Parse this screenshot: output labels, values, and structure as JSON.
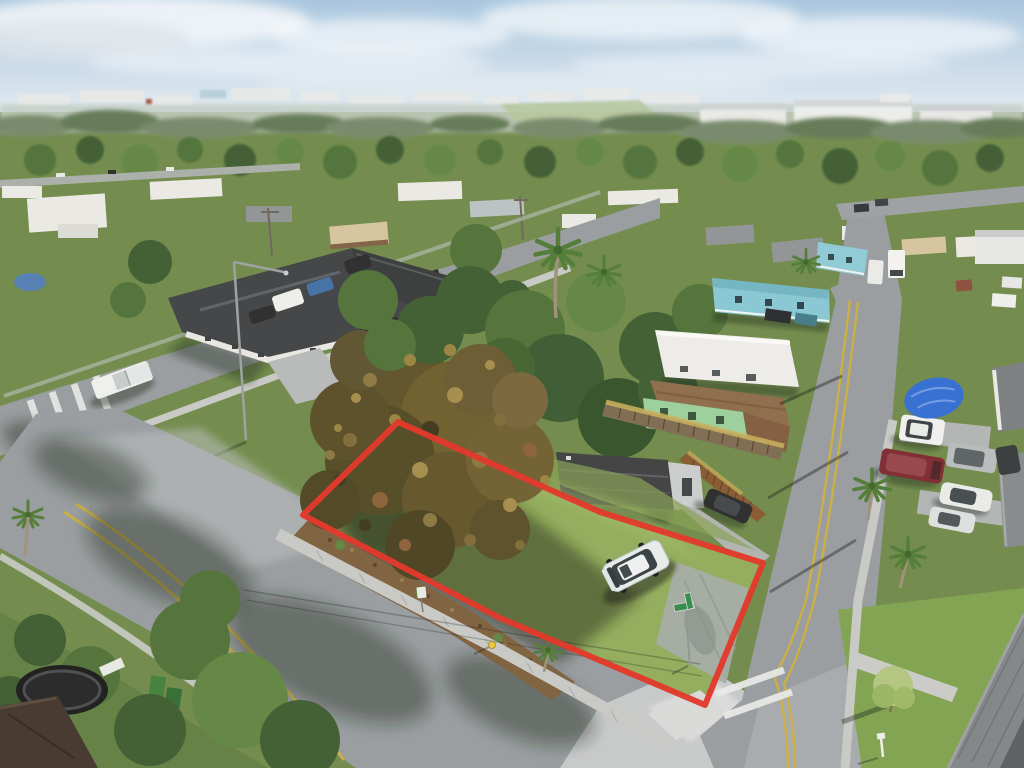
{
  "scene": {
    "type": "aerial-drone-photo",
    "subject": "Vacant corner lot outlined in red at a residential intersection",
    "setting": "Low-rise suburban neighborhood, hazy horizon, low warm sunlight with long shadows",
    "view": "High oblique aerial view",
    "width_px": 1024,
    "height_px": 768
  },
  "palette": {
    "sky_top": "#a9c6de",
    "sky_bottom": "#e9eff3",
    "horizon_haze": "#c5cfc6",
    "ground_green": "#6d8a4b",
    "lot_grass": "#8fab5c",
    "grass_bright": "#7da24f",
    "road": "#959ba1",
    "road_bright": "#c6cacd",
    "sidewalk": "#c7cac9",
    "mulch": "#7b5e3e",
    "tree_rust": "#6b5c2c",
    "yellow_line": "#cdb039",
    "outline_red": "#e23127"
  },
  "lot": {
    "label": "Subject property boundary",
    "outline_points": "398,422 600,512 763,563 705,705 500,618 303,515",
    "outline_color": "#e23127",
    "outline_width": "6"
  },
  "objects": {
    "suv": {
      "label": "White boxy SUV parked on the lot",
      "color": "#e6edef",
      "cx": 636,
      "cy": 566
    },
    "big_tree": {
      "label": "Large rust-olive tree on west corner of lot",
      "color": "#6b5c2c",
      "cx": 435,
      "cy": 455
    },
    "shed": {
      "label": "Dark storage trailer behind lot",
      "color": "#3b3e42",
      "cx": 615,
      "cy": 480
    },
    "green_house": {
      "label": "Mint-green house with brown roof",
      "color": "#98d09c",
      "cx": 710,
      "cy": 415
    },
    "fence": {
      "label": "Wooden privacy fence with vine top",
      "color": "#7a6a52",
      "cx": 695,
      "cy": 440
    },
    "mobile_home": {
      "label": "Long white mobile home",
      "color": "#eceeee",
      "cx": 727,
      "cy": 358
    },
    "blue_house": {
      "label": "Light-blue house",
      "color": "#84c8d6",
      "cx": 770,
      "cy": 300
    },
    "blue_tarp": {
      "label": "Blue tarp over boat",
      "color": "#2f6cd6",
      "cx": 934,
      "cy": 398
    },
    "maroon_van": {
      "label": "Maroon van parked on side street",
      "color": "#7c2830",
      "cx": 912,
      "cy": 466
    },
    "white_pickup": {
      "label": "White pickup truck on NW street",
      "color": "#eff1f1",
      "cx": 122,
      "cy": 380
    },
    "street_sign": {
      "label": "Green street-name sign at corner",
      "color": "#2f8a4a",
      "cx": 684,
      "cy": 607
    },
    "fire_hydrant": {
      "label": "Yellow fire hydrant by sidewalk",
      "color": "#e8c93e",
      "cx": 492,
      "cy": 645
    },
    "trampoline": {
      "label": "Backyard trampoline lower-left",
      "color": "#17191b",
      "cx": 62,
      "cy": 690
    },
    "duplex": {
      "label": "Dark-roof duplex on NW street",
      "color": "#3c4045",
      "cx": 310,
      "cy": 305
    }
  }
}
